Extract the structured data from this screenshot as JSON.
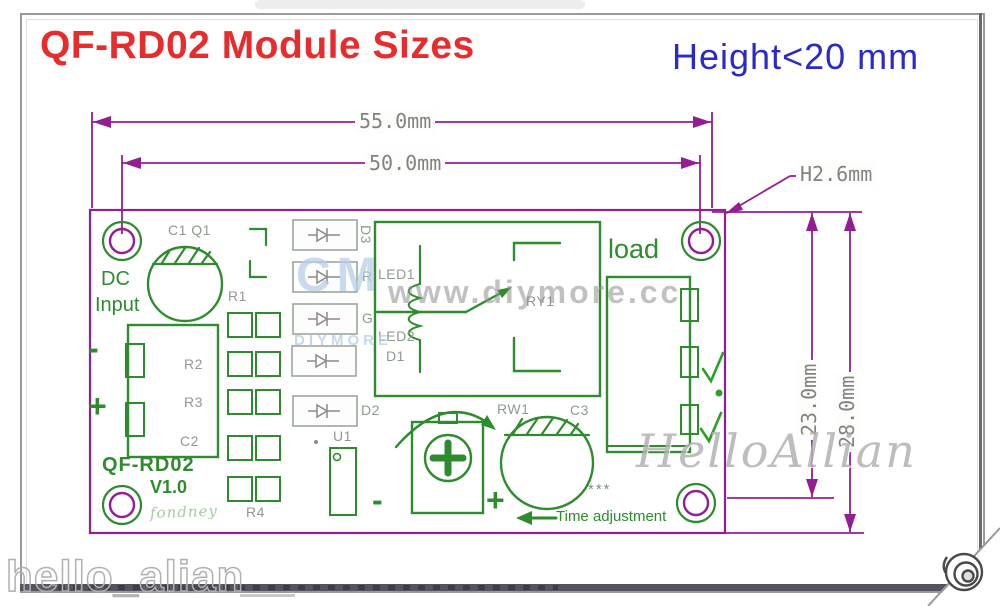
{
  "header": {
    "title": "QF-RD02 Module Sizes",
    "height_note": "Height<20 mm"
  },
  "dimensions": {
    "outer_width": "55.0mm",
    "inner_width": "50.0mm",
    "hole_height": "H2.6mm",
    "inner_height": "23.0mm",
    "outer_height": "28.0mm"
  },
  "board": {
    "dc_line1": "DC",
    "dc_line2": "Input",
    "model": "QF-RD02",
    "version": "V1.0",
    "signature": "fondney",
    "load": "load",
    "minus": "-",
    "plus": "+",
    "stars": "***",
    "time_adjustment": "Time adjustment",
    "labels": {
      "c1q1": "C1 Q1",
      "r1": "R1",
      "r2": "R2",
      "r3": "R3",
      "r4": "R4",
      "c2": "C2",
      "c3": "C3",
      "d1": "D1",
      "d2": "D2",
      "d3": "D3",
      "u1": "U1",
      "led1": "LED1",
      "led2": "LED2",
      "ry1": "RY1",
      "rw1": "RW1",
      "r": "R",
      "g": "G"
    }
  },
  "watermarks": {
    "logo_big": "CM",
    "logo_small": "DIYMORE",
    "url": "www.diymore.cc",
    "script": "HelloAllian",
    "bottom": "hello_alian"
  },
  "colors": {
    "title_red": "#e62c2c",
    "note_blue": "#2a2ac8",
    "dimension_purple": "#941d94",
    "silkscreen_green": "#2e8b2e",
    "label_gray": "#8f9a8f"
  }
}
